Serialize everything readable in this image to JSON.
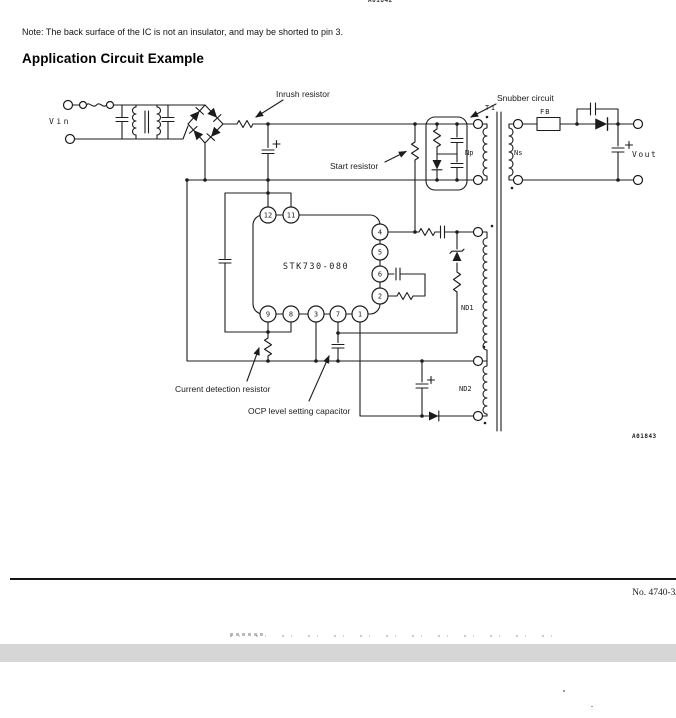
{
  "page": {
    "top_code": "A01842",
    "note": "Note: The back surface of the IC is not an insulator, and may be shorted to pin 3.",
    "heading": "Application Circuit Example",
    "figure_code": "A01843",
    "page_number": "No. 4740-3/"
  },
  "circuit": {
    "ic_label": "STK730-080",
    "vin": "Vin",
    "vout": "Vout",
    "t1": "T1",
    "np": "Np",
    "ns": "Ns",
    "nd1": "ND1",
    "nd2": "ND2",
    "fb": "FB",
    "annotations": {
      "inrush": "Inrush resistor",
      "snubber": "Snubber circuit",
      "start": "Start resistor",
      "current_detection": "Current detection resistor",
      "ocp": "OCP level setting capacitor"
    },
    "pins": {
      "p12": "12",
      "p11": "11",
      "p4": "4",
      "p5": "5",
      "p6": "6",
      "p2": "2",
      "p9": "9",
      "p8": "8",
      "p3": "3",
      "p7": "7",
      "p1": "1"
    }
  },
  "colors": {
    "ink": "#1c1c1c",
    "gray_bar": "#d6d6d6"
  }
}
